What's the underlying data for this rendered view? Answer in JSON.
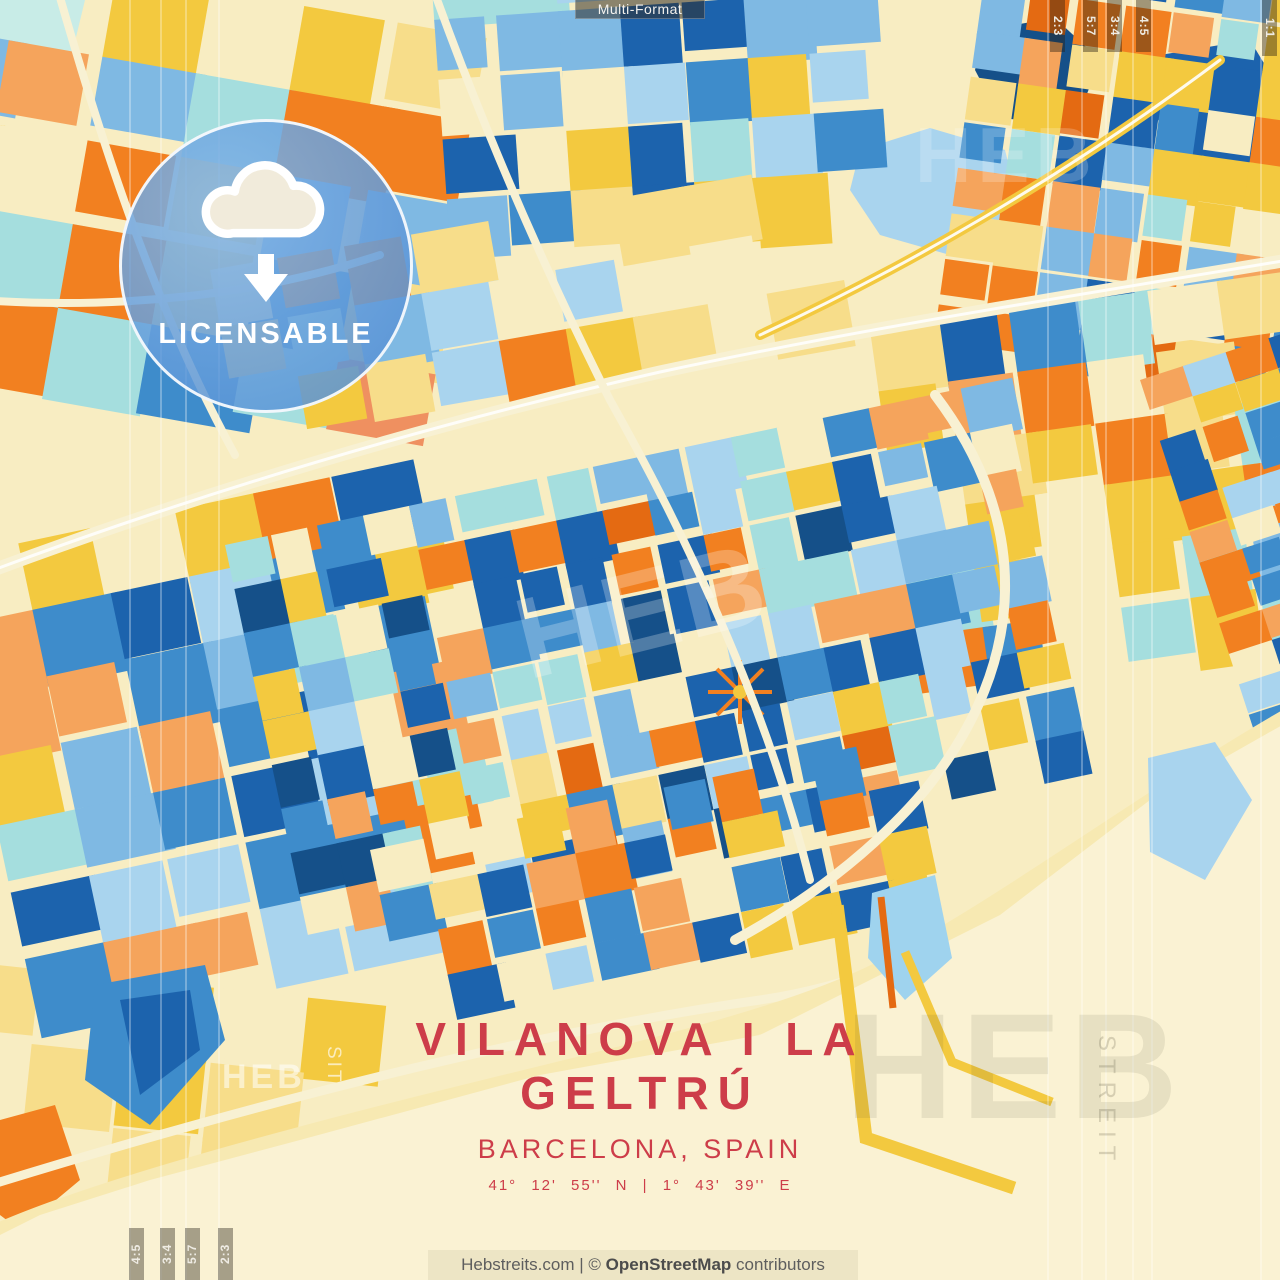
{
  "format_bar": {
    "label": "Multi-Format"
  },
  "format_tabs": {
    "top_right": [
      "2:3",
      "5:7",
      "3:4",
      "4:5"
    ],
    "edge": "1:1",
    "bottom_left": [
      "4:5",
      "3:4",
      "5:7",
      "2:3"
    ]
  },
  "badge": {
    "label": "LICENSABLE"
  },
  "title": {
    "line1": "VILANOVA I LA",
    "line2": "GELTRÚ",
    "subtitle": "BARCELONA, SPAIN",
    "coordinates": "41°  12'  55'' N  |  1°  43'  39'' E"
  },
  "footer": {
    "site": "Hebstreits.com",
    "separator": "|",
    "copyright": "©",
    "attribution": "OpenStreetMap",
    "suffix": "contributors"
  },
  "watermarks": {
    "brand": "HEB",
    "brand_vertical": "STREIT",
    "fragment": "SIT"
  },
  "palette": {
    "cream": "#f8edc2",
    "road": "#f8f1d3",
    "seaCream": "#faf2d3",
    "beach": "#f7e9b2",
    "yellow": "#f3c93f",
    "paleYellow": "#f7dd8a",
    "orange": "#f28020",
    "orangeLight": "#f5a45c",
    "orangeDark": "#e46a12",
    "salmon": "#ef9060",
    "blueNavy": "#155089",
    "blueDark": "#1c63ad",
    "blue": "#3e8ccb",
    "blueLight": "#7fb9e3",
    "bluePale": "#a9d4ee",
    "cyan": "#a5dede",
    "cyanPale": "#c8ece7",
    "harborBlue": "#9fd3ee",
    "titleRed": "#cd3d49",
    "white": "#ffffff"
  }
}
